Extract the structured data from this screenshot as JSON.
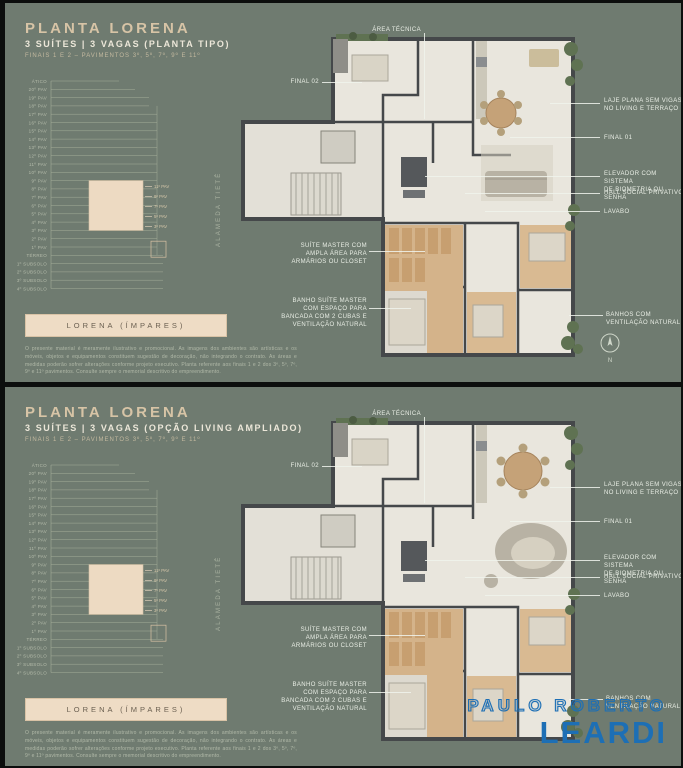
{
  "colors": {
    "background": "#6f7b70",
    "title": "#d7c4a6",
    "stack_line": "#a4ad99",
    "stack_label": "#b5bcab",
    "highlight": "#eddac2",
    "highlight_border": "#d8c2a4",
    "highlight_label": "#d8c9ab",
    "callout_text": "#e9eee5",
    "plan_wall": "#45484a",
    "plan_floor": "#e9e6dd",
    "wood": "#d4b38a",
    "green": "#5f7252",
    "logo_blue": "#1d6fb5"
  },
  "panels": [
    {
      "title": "PLANTA LORENA",
      "subtitle": "3 SUÍTES | 3 VAGAS (PLANTA TIPO)",
      "meta": "FINAIS 1 E 2 – PAVIMENTOS 3º, 5º, 7º, 9º E 11º",
      "street": "ALAMEDA TIETÊ",
      "stack": {
        "floors": [
          "ÁTICO",
          "20º PAV",
          "19º PAV",
          "18º PAV",
          "17º PAV",
          "16º PAV",
          "15º PAV",
          "14º PAV",
          "13º PAV",
          "12º PAV",
          "11º PAV",
          "10º PAV",
          "9º PAV",
          "8º PAV",
          "7º PAV",
          "6º PAV",
          "5º PAV",
          "4º PAV",
          "3º PAV",
          "2º PAV",
          "1º PAV",
          "TÉRREO",
          "1º SUBSOLO",
          "2º SUBSOLO",
          "3º SUBSOLO",
          "4º SUBSOLO"
        ],
        "highlight_floors": [
          "11º PAV",
          "9º PAV",
          "7º PAV",
          "5º PAV",
          "3º PAV"
        ],
        "unit_label": "LORENA (ÍMPARES)"
      },
      "callouts": {
        "area_tecnica": "ÁREA TÉCNICA",
        "final_02": "FINAL 02",
        "laje": "LAJE PLANA SEM VIGAS\nNO LIVING E TERRAÇO",
        "final_01": "FINAL 01",
        "elevador": "ELEVADOR COM SISTEMA\nDE BIOMETRIA OU SENHA",
        "hall": "HALL SOCIAL PRIVATIVO",
        "lavabo": "LAVABO",
        "suite_master": "SUÍTE MASTER COM\nAMPLA ÁREA PARA\nARMÁRIOS OU CLOSET",
        "banho_master": "BANHO SUÍTE MASTER\nCOM ESPAÇO PARA\nBANCADA COM 2 CUBAS E\nVENTILAÇÃO NATURAL",
        "banhos": "BANHOS COM\nVENTILAÇÃO NATURAL"
      },
      "compass": "N",
      "disclaimer": "O presente material é meramente ilustrativo e promocional. As imagens dos ambientes são artísticas e os móveis, objetos e equipamentos constituem sugestão de decoração, não integrando o contrato. As áreas e medidas poderão sofrer alterações conforme projeto executivo. Planta referente aos finais 1 e 2 dos 3º, 5º, 7º, 9º e 11º pavimentos. Consulte sempre o memorial descritivo do empreendimento."
    },
    {
      "title": "PLANTA LORENA",
      "subtitle": "3 SUÍTES | 3 VAGAS (OPÇÃO LIVING AMPLIADO)",
      "meta": "FINAIS 1 E 2 – PAVIMENTOS 3º, 5º, 7º, 9º E 11º",
      "street": "ALAMEDA TIETÊ",
      "stack": {
        "floors": [
          "ÁTICO",
          "20º PAV",
          "19º PAV",
          "18º PAV",
          "17º PAV",
          "16º PAV",
          "15º PAV",
          "14º PAV",
          "13º PAV",
          "12º PAV",
          "11º PAV",
          "10º PAV",
          "9º PAV",
          "8º PAV",
          "7º PAV",
          "6º PAV",
          "5º PAV",
          "4º PAV",
          "3º PAV",
          "2º PAV",
          "1º PAV",
          "TÉRREO",
          "1º SUBSOLO",
          "2º SUBSOLO",
          "3º SUBSOLO",
          "4º SUBSOLO"
        ],
        "highlight_floors": [
          "11º PAV",
          "9º PAV",
          "7º PAV",
          "5º PAV",
          "3º PAV"
        ],
        "unit_label": "LORENA (ÍMPARES)"
      },
      "callouts": {
        "area_tecnica": "ÁREA TÉCNICA",
        "final_02": "FINAL 02",
        "laje": "LAJE PLANA SEM VIGAS\nNO LIVING E TERRAÇO",
        "final_01": "FINAL 01",
        "elevador": "ELEVADOR COM SISTEMA\nDE BIOMETRIA OU SENHA",
        "hall": "HALL SOCIAL PRIVATIVO",
        "lavabo": "LAVABO",
        "suite_master": "SUÍTE MASTER COM\nAMPLA ÁREA PARA\nARMÁRIOS OU CLOSET",
        "banho_master": "BANHO SUÍTE MASTER\nCOM ESPAÇO PARA\nBANCADA COM 2 CUBAS E\nVENTILAÇÃO NATURAL",
        "banhos": "BANHOS COM\nVENTILAÇÃO NATURAL"
      },
      "logo": {
        "line1": "PAULO ROBERTO",
        "line2": "LEARDI"
      },
      "disclaimer": "O presente material é meramente ilustrativo e promocional. As imagens dos ambientes são artísticas e os móveis, objetos e equipamentos constituem sugestão de decoração, não integrando o contrato. As áreas e medidas poderão sofrer alterações conforme projeto executivo. Planta referente aos finais 1 e 2 dos 3º, 5º, 7º, 9º e 11º pavimentos. Consulte sempre o memorial descritivo do empreendimento."
    }
  ]
}
